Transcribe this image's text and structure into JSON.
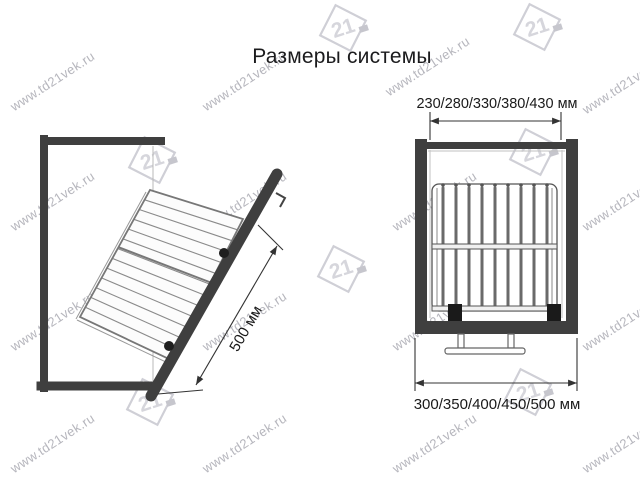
{
  "title": "Размеры системы",
  "watermark": {
    "text": "www.td21vek.ru",
    "logo_text": "21"
  },
  "left_view": {
    "description": "side view of cabinet with tilted pull-out wire basket on door",
    "dimension_label": "500 мм"
  },
  "right_view": {
    "description": "front view of cabinet with wire basket and floor mount",
    "top_dimension_label": "230/280/330/380/430 мм",
    "bottom_dimension_label": "300/350/400/450/500 мм"
  },
  "colors": {
    "cabinet_dark": "#3f3f3f",
    "line": "#333333",
    "wire": "#6a6a6a",
    "thin_wire": "#8a8a8a",
    "watermark": "#b6b6bd",
    "logo": "#cfcfd6",
    "title_text": "#1b1b1d"
  }
}
